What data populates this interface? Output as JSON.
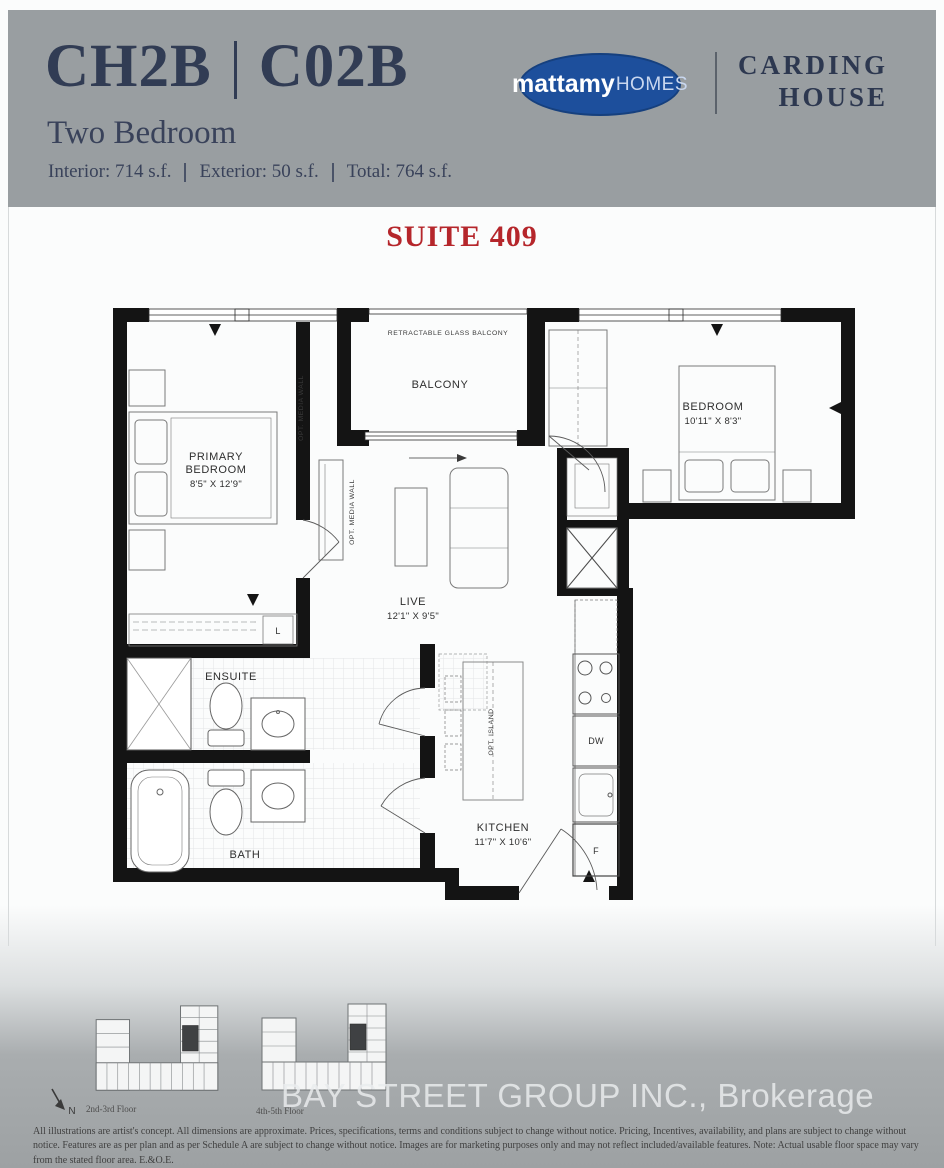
{
  "header": {
    "model": "CH2B",
    "unit": "C02B",
    "plan_type": "Two Bedroom",
    "areas": {
      "interior": "Interior: 714 s.f.",
      "exterior": "Exterior: 50 s.f.",
      "total": "Total: 764 s.f."
    },
    "brand": {
      "logo_primary": "mattamy",
      "logo_secondary": "HOMES",
      "building_line1": "CARDING",
      "building_line2": "HOUSE"
    },
    "accent_navy": "#313c54",
    "logo_blue": "#1d4f9c"
  },
  "suite": {
    "label": "SUITE 409",
    "color": "#b5262b"
  },
  "floorplan": {
    "balcony_note": "RETRACTABLE GLASS BALCONY",
    "rooms": {
      "balcony": {
        "name": "BALCONY"
      },
      "primary_bedroom": {
        "name_line1": "PRIMARY",
        "name_line2": "BEDROOM",
        "dims": "8'5\" X 12'9\""
      },
      "bedroom": {
        "name": "BEDROOM",
        "dims": "10'11\" X 8'3\""
      },
      "live": {
        "name": "LIVE",
        "dims": "12'1\" X 9'5\""
      },
      "kitchen": {
        "name": "KITCHEN",
        "dims": "11'7\" X 10'6\""
      },
      "ensuite": {
        "name": "ENSUITE"
      },
      "bath": {
        "name": "BATH"
      }
    },
    "annotations": {
      "opt_media_wall": "OPT. MEDIA WALL",
      "opt_island": "OPT. ISLAND",
      "dishwasher": "DW",
      "fridge": "F",
      "laundry": "L"
    }
  },
  "keyplans": [
    {
      "caption": "2nd-3rd Floor"
    },
    {
      "caption": "4th-5th Floor"
    }
  ],
  "north_label": "N",
  "watermark": "BAY STREET GROUP INC., Brokerage",
  "disclaimer": "All illustrations are artist's concept. All dimensions are approximate. Prices, specifications, terms and conditions subject to change without notice. Pricing, Incentives, availability, and plans are subject to change without notice. Features are as per plan and as per Schedule A are subject to change without notice. Images are for marketing purposes only and may not reflect included/available features. Note: Actual usable floor space may vary from the stated floor area. E.&O.E."
}
